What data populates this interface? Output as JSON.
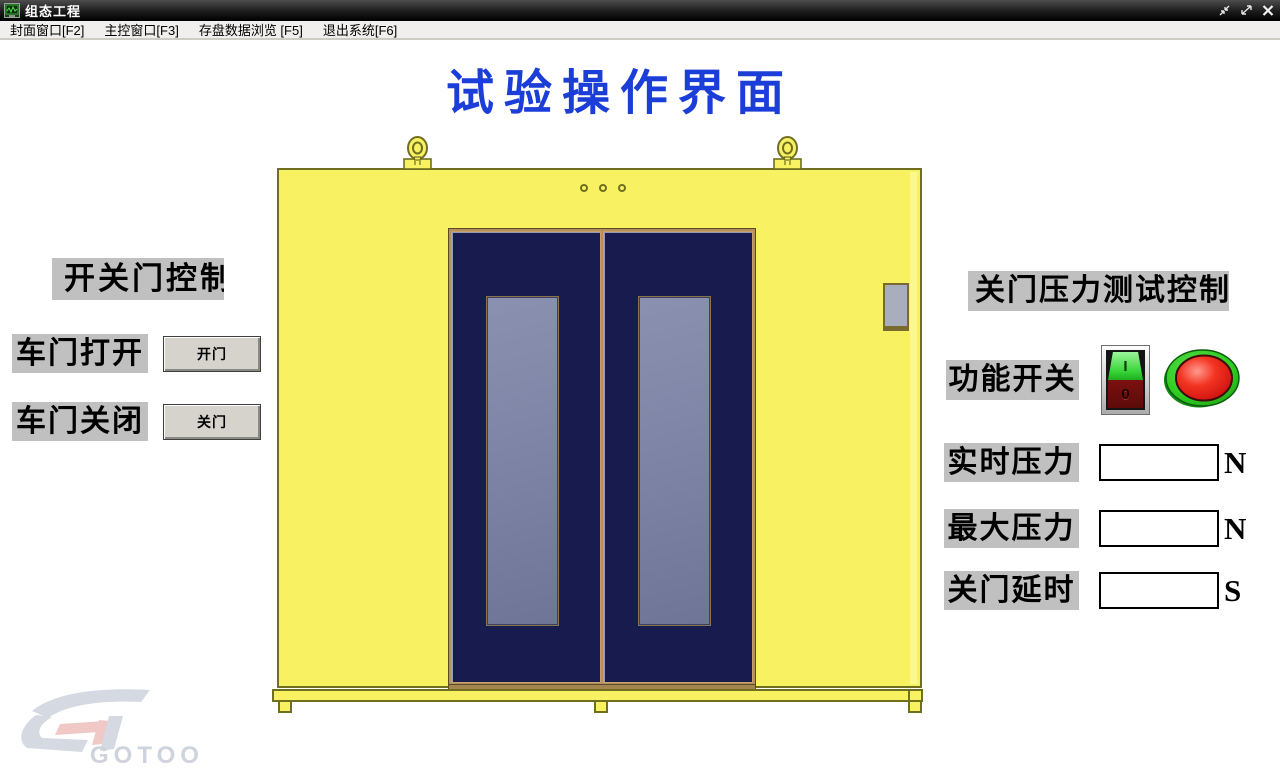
{
  "window": {
    "title": "组态工程"
  },
  "menu": {
    "items": [
      {
        "label": "封面窗口[F2]"
      },
      {
        "label": "主控窗口[F3]"
      },
      {
        "label": "存盘数据浏览 [F5]"
      },
      {
        "label": "退出系统[F6]"
      }
    ]
  },
  "main": {
    "title": "试验操作界面"
  },
  "left_panel": {
    "heading": "开关门控制",
    "rows": [
      {
        "label": "车门打开",
        "button": "开门"
      },
      {
        "label": "车门关闭",
        "button": "关门"
      }
    ]
  },
  "right_panel": {
    "heading": "关门压力测试控制",
    "switch_label": "功能开关",
    "rocker": {
      "on": "I",
      "off": "0"
    },
    "fields": [
      {
        "label": "实时压力",
        "value": "",
        "unit": "N"
      },
      {
        "label": "最大压力",
        "value": "",
        "unit": "N"
      },
      {
        "label": "关门延时",
        "value": "",
        "unit": "S"
      }
    ]
  },
  "watermark": {
    "text": "GOTOO"
  },
  "colors": {
    "title_blue": "#1c3ed8",
    "label_bg": "#c0c0c0",
    "cabinet_yellow": "#f8f263",
    "cabinet_border": "#6f6f1f",
    "door_navy": "#171b4d",
    "door_window_slate": "#7f86a5",
    "lamp_red": "#ee1515",
    "lamp_green_ring": "#2ecc22",
    "rocker_green": "#37d437",
    "rocker_red": "#6e0d0d"
  }
}
